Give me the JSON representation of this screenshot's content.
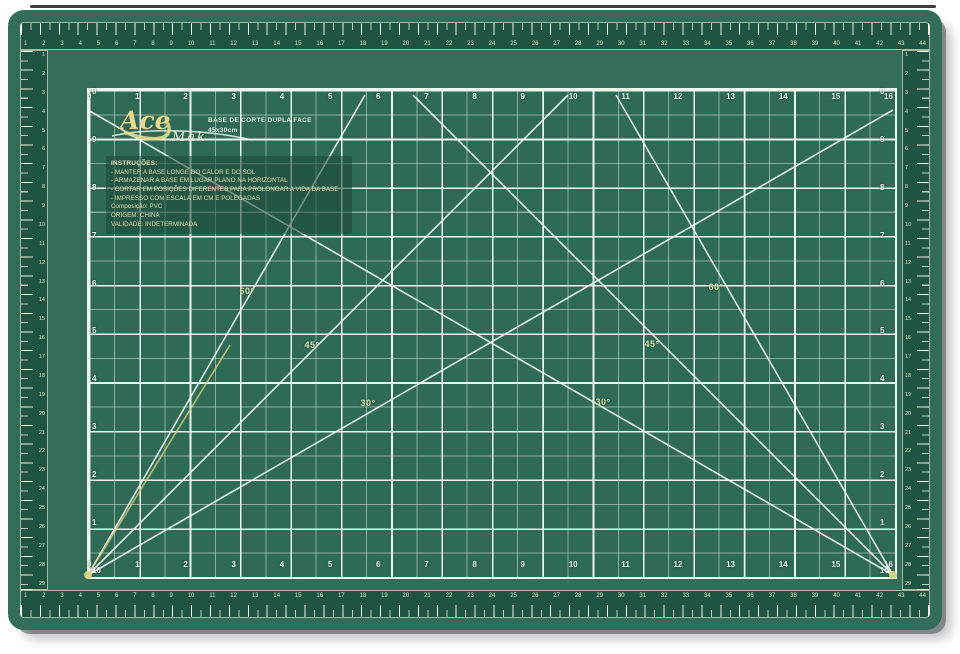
{
  "product": {
    "brand_script": "Ace",
    "brand_sub": "Mak",
    "title_line1": "BASE DE CORTE DUPLA FACE",
    "title_line2": "45x30cm"
  },
  "instructions": {
    "heading": "INSTRUÇÕES:",
    "lines": [
      "- MANTER A BASE LONGE DO CALOR E DO SOL",
      "- ARMAZENAR A BASE EM LUGAR PLANO NA HORIZONTAL",
      "- CORTAR EM POSIÇÕES DIFERENTES PARA PROLONGAR A VIDA DA BASE",
      "- IMPRESSO COM ESCALA EM CM E POLEGADAS",
      "Composição: PVC",
      "ORIGEM: CHINA",
      "VALIDADE: INDETERMINADA"
    ]
  },
  "angles": {
    "l60": "60°",
    "l45": "45°",
    "l30": "30°",
    "r60": "60°",
    "r45": "45°",
    "r30": "30°"
  },
  "grid": {
    "h_labels": [
      "0",
      "1",
      "2",
      "3",
      "4",
      "5",
      "6",
      "7",
      "8",
      "9",
      "10",
      "11",
      "12",
      "13",
      "14",
      "15",
      "16"
    ],
    "v_labels": [
      "0",
      "9",
      "8",
      "7",
      "6",
      "5",
      "4",
      "3",
      "2",
      "1",
      "10"
    ]
  },
  "rulers": {
    "cm_top": [
      "1",
      "2",
      "3",
      "4",
      "5",
      "6",
      "7",
      "8",
      "9",
      "10",
      "11",
      "12",
      "13",
      "14",
      "15",
      "16",
      "17",
      "18",
      "19",
      "20",
      "21",
      "22",
      "23",
      "24",
      "25",
      "26",
      "27",
      "28",
      "29",
      "30",
      "31",
      "32",
      "33",
      "34",
      "35",
      "36",
      "37",
      "38",
      "39",
      "40",
      "41",
      "42",
      "43",
      "44"
    ],
    "cm_side": [
      "1",
      "2",
      "3",
      "4",
      "5",
      "6",
      "7",
      "8",
      "9",
      "10",
      "11",
      "12",
      "13",
      "14",
      "15",
      "16",
      "17",
      "18",
      "19",
      "20",
      "21",
      "22",
      "23",
      "24",
      "25",
      "26",
      "27",
      "28",
      "29"
    ]
  },
  "colors": {
    "mat_green": "#336c58",
    "grid_green": "#2f6a56",
    "band_green": "#1f5443",
    "line_cream": "#e9f4ec",
    "label_yellow": "#d6e3ae",
    "logo_yellow": "#e9d88a",
    "dot_yellow": "#d6d77e",
    "text_cream": "#dedcab"
  }
}
